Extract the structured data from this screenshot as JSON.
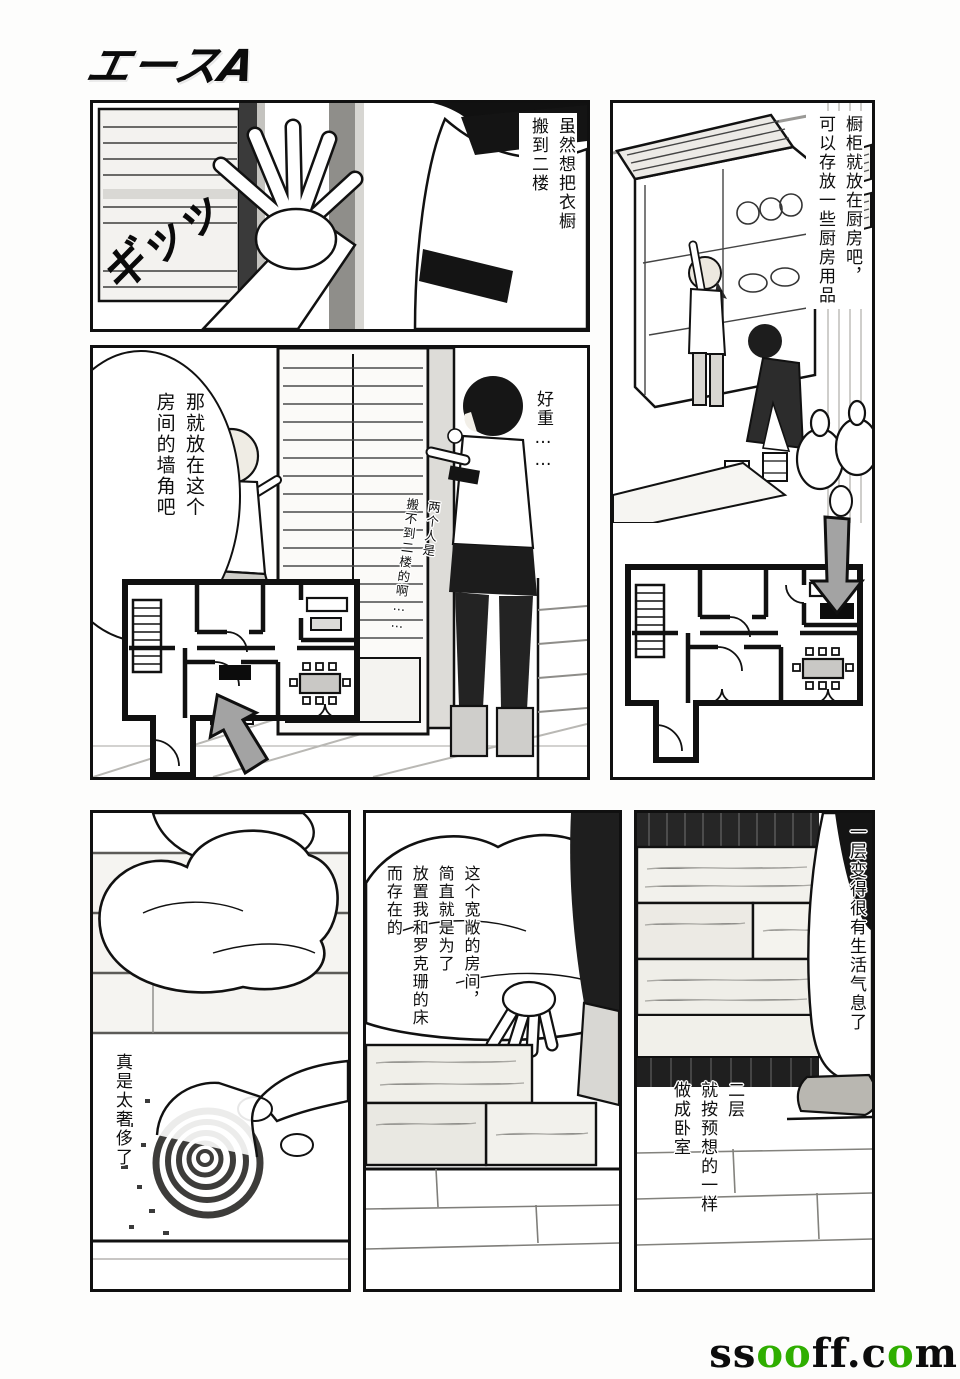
{
  "logo": {
    "text": "エースA"
  },
  "colors": {
    "ink": "#101010",
    "paper": "#ffffff",
    "arrow_gray": "#a3a3a3",
    "watermark_green": "#2fae00"
  },
  "panel_push": {
    "caption": {
      "col1": "虽然想把衣橱",
      "col2": "搬到二楼"
    },
    "sfx": "ギッッ"
  },
  "panel_kitchen": {
    "caption": {
      "col1": "橱柜就放在厨房吧，",
      "col2": "可以存放一些厨房用品"
    }
  },
  "panel_corner": {
    "bubble": {
      "col1": "那就放在这个",
      "col2": "房间的墙角吧"
    },
    "heavy": "好重……",
    "aside": {
      "col1": "两个人是",
      "col2": "搬不到二楼的啊……"
    }
  },
  "panel_rug": {
    "caption": "真是太奢侈了"
  },
  "panel_bed": {
    "caption": {
      "col1": "这个宽敞的房间，",
      "col2": "简直就是为了",
      "col3": "放置我和罗克珊的床",
      "col4": "而存在的"
    }
  },
  "panel_bedroom": {
    "caption_first_floor": "一层变得很有生活气息了",
    "caption_second_floor": {
      "col1": "二层",
      "col2": "就按预想的一样",
      "col3": "做成卧室"
    }
  },
  "watermark": {
    "p1": "ss",
    "p2": "oo",
    "p3": "ff.c",
    "p4": "o",
    "p5": "m"
  }
}
